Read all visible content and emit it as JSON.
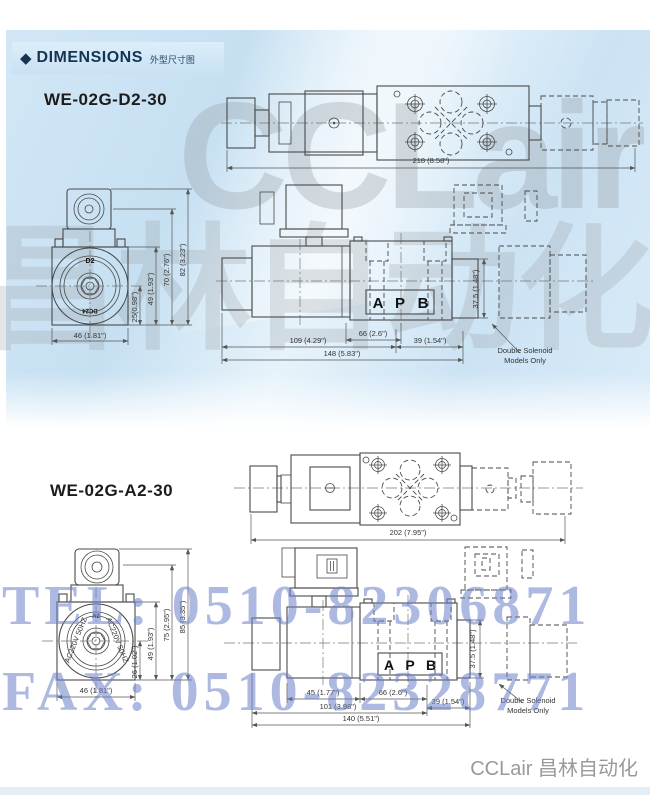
{
  "header": {
    "diamond": "◆",
    "title": "DIMENSIONS",
    "subtitle": "外型尺寸图"
  },
  "watermarks": {
    "logo": "CCLair",
    "cn": "昌林自动化",
    "tel": "TEL: 0510-82306871",
    "fax": "FAX: 0510-82328771"
  },
  "footer": {
    "brand": "CCLair 昌林自动化"
  },
  "model1": {
    "name": "WE-02G-D2-30",
    "top_view": {
      "width_dim": "218 (8.58\")"
    },
    "side_view": {
      "label_top": "D2",
      "label_bottom": "DC24",
      "dim_25": "25(0.98\")",
      "dim_49": "49 (1.93\")",
      "dim_70": "70 (2.76\")",
      "dim_82": "82 (3.23\")",
      "dim_46": "46 (1.81\")"
    },
    "front_view": {
      "dim_66": "66 (2.6\")",
      "dim_109": "109 (4.29\")",
      "dim_39": "39 (1.54\")",
      "dim_148": "148 (5.83\")",
      "dim_375": "37.5 (1.48\")",
      "port_a": "A",
      "port_p": "P",
      "port_b": "B",
      "note1": "Double Solenoid",
      "note2": "Models Only"
    }
  },
  "model2": {
    "name": "WE-02G-A2-30",
    "top_view": {
      "width_dim": "202 (7.95\")"
    },
    "side_view": {
      "label_top": "A2",
      "label_left": "AC220V 50HZ",
      "label_right": "AC220V 50HZ",
      "dim_26": "26 (1.02\")",
      "dim_49": "49 (1.93\")",
      "dim_75": "75 (2.95\")",
      "dim_85": "85 (3.35\")",
      "dim_46": "46 (1.81\")"
    },
    "front_view": {
      "dim_45": "45 (1.77\")",
      "dim_66": "66 (2.6\")",
      "dim_101": "101 (3.98\")",
      "dim_39": "39 (1.54\")",
      "dim_140": "140 (5.51\")",
      "dim_375": "37.5 (1.48\")",
      "port_a": "A",
      "port_p": "P",
      "port_b": "B",
      "note1": "Double Solenoid",
      "note2": "Models Only"
    }
  }
}
